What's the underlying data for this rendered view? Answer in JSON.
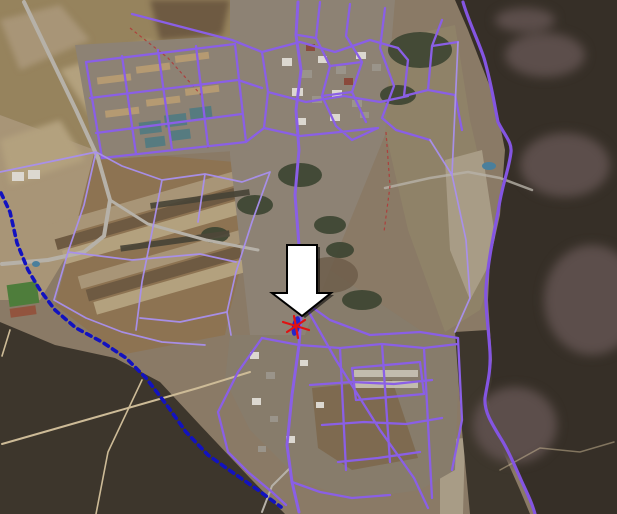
{
  "map": {
    "kind": "aerial-imagery-with-gis-overlays",
    "overlays": {
      "roads_layer": "road-network",
      "boundary_layer": "boundary-line",
      "winding_road": "rural-road",
      "pointer": "down-arrow",
      "marker": "red-cross-marker"
    }
  },
  "colors": {
    "road_purple": "#8a5fe6",
    "road_purple_light": "#a98fee",
    "winding_road_purple": "#8455e2",
    "boundary_blue": "#1212c0",
    "cadastral_red": "#b23636",
    "marker_red": "#e01212",
    "marker_blue": "#2525cc",
    "arrow_fill": "#ffffff",
    "arrow_outline": "#000000",
    "terrain_base": "#8a7a66",
    "farmland_mid": "#96835d",
    "farmland_pale": "#a89577",
    "farmland_light": "#b3a17e",
    "field_brown": "#8d7352",
    "field_dark": "#6e5a42",
    "forest_dark": "#362f27",
    "forest_dark2": "#3d362c",
    "forest_mauve": "#5c4e4b",
    "right_fields": "#8f8268",
    "field_pale2": "#a89c86",
    "town_ground": "#8d8274",
    "town_ground2": "#877c6b",
    "road_gray": "#b6b1a8",
    "dirt_road": "#cdbb97",
    "sports_green": "#4e7d3b",
    "track_red": "#92543e",
    "water_blue": "#4a7f9c",
    "building_white": "#dcd8d0",
    "building_gray": "#9a948a",
    "building_tan": "#b59a72",
    "building_teal": "#567b80",
    "building_red": "#8a4a3c",
    "tree_dark": "#3c4431",
    "hedge_dark": "#474336",
    "brown_patch": "#7e6a50",
    "scrub_brown": "#6b5b48"
  }
}
